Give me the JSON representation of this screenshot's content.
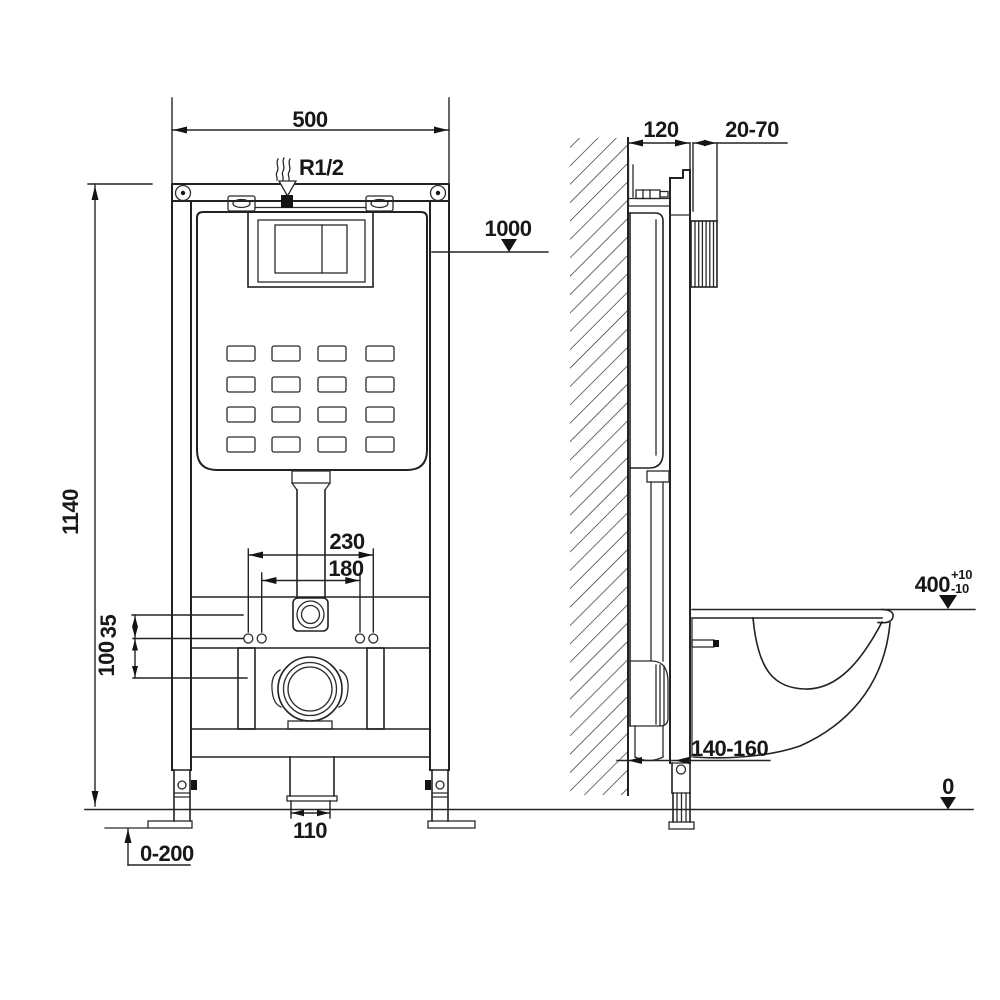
{
  "drawing": {
    "front_view": {
      "frame_width": "500",
      "water_inlet_thread": "R1/2",
      "panel_height_level": "1000",
      "total_height": "1140",
      "fixing_spacing_outer": "230",
      "fixing_spacing_inner": "180",
      "flush_pipe_offset": "35",
      "drain_level_offset": "100",
      "outlet_width": "110",
      "foot_adjustment_range": "0-200"
    },
    "side_view": {
      "frame_depth": "120",
      "wall_finish_range": "20-70",
      "bowl_top_height": "400",
      "bowl_height_tolerance_plus": "+10",
      "bowl_height_tolerance_minus": "-10",
      "outlet_wall_distance": "140-160",
      "floor_level": "0"
    }
  }
}
